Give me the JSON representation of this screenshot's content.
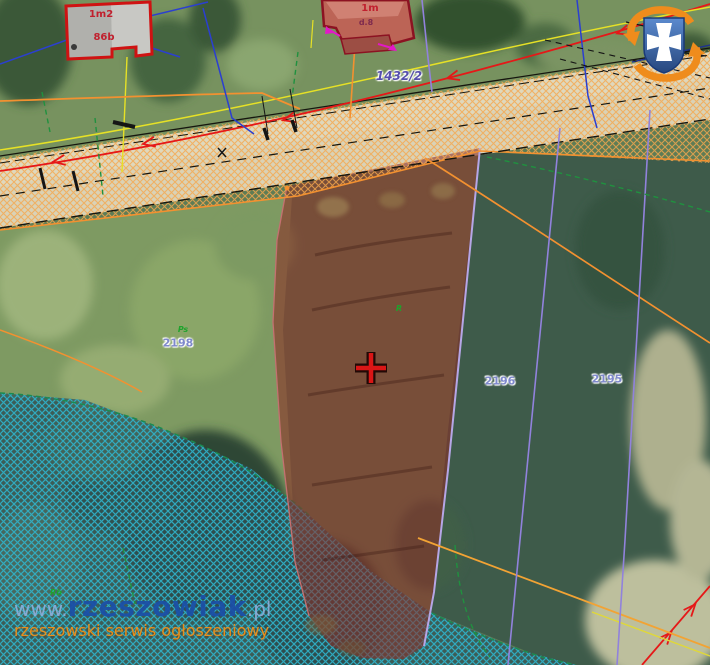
{
  "site": {
    "watermark_www": "www.",
    "watermark_name": "rzeszowiak",
    "watermark_tld": ".pl",
    "watermark_tagline": "rzeszowski serwis ogłoszeniowy"
  },
  "map": {
    "road_parcel_label": "1432/2",
    "parcel_left": "2198",
    "parcel_mid": "2196",
    "parcel_right": "2195",
    "building_left_top": "1m2",
    "building_left_bottom": "86b",
    "building_center": "1m",
    "building_center_small": "d.8",
    "landuse_left": "Ps",
    "landuse_parcel": "R",
    "landuse_bottom": "Rb",
    "colors": {
      "highlight_parcel": "#8a2c26",
      "marker_cross": "#da1616",
      "road_hatch": "#f5a84e",
      "water_hatch": "#2fb3cb",
      "brand_blue": "#1c50a6",
      "brand_orange": "#f29018"
    }
  }
}
